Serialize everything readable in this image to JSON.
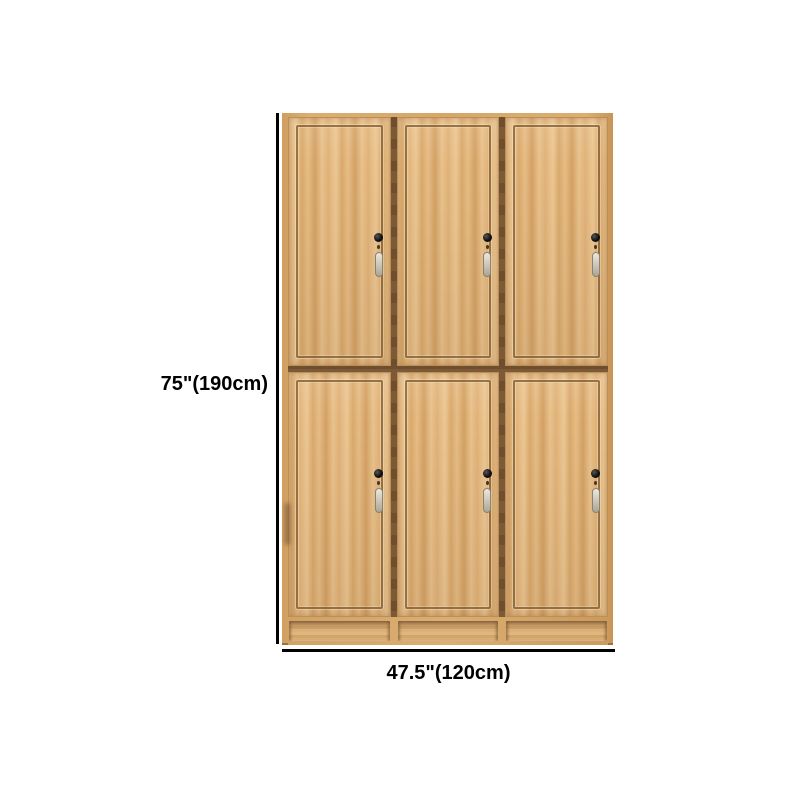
{
  "page": {
    "background": "#ffffff",
    "description": "E-commerce product dimension image of a six-door wooden locker wardrobe"
  },
  "product": {
    "name": "wood-locker-cabinet",
    "rows": 2,
    "columns": 3,
    "door_count": 6,
    "features": [
      "inset door panels",
      "black cam lock per door",
      "hanging metal key fob per door",
      "recessed base kick panels"
    ]
  },
  "dimensions": {
    "height_label": "75\"(190cm)",
    "width_label": "47.5\"(120cm)"
  },
  "icons": {
    "lock_keyhole": "black round cam lock cylinder",
    "lock_screw": "small screw dot under lock",
    "hanging_key": "metal key fob hanging below lock"
  },
  "colors": {
    "background": "#ffffff",
    "wood_base": "#dfb078",
    "wood_light_streak": "#ecc793",
    "wood_dark_streak": "#d3a164",
    "frame_wood": "#d7a76a",
    "panel_outline": "#805c34",
    "door_seam": "#6e4e2e",
    "lock_black": "#111111",
    "key_metal": "#cfcabc",
    "dimension_line": "#000000",
    "dimension_text": "#000000"
  }
}
